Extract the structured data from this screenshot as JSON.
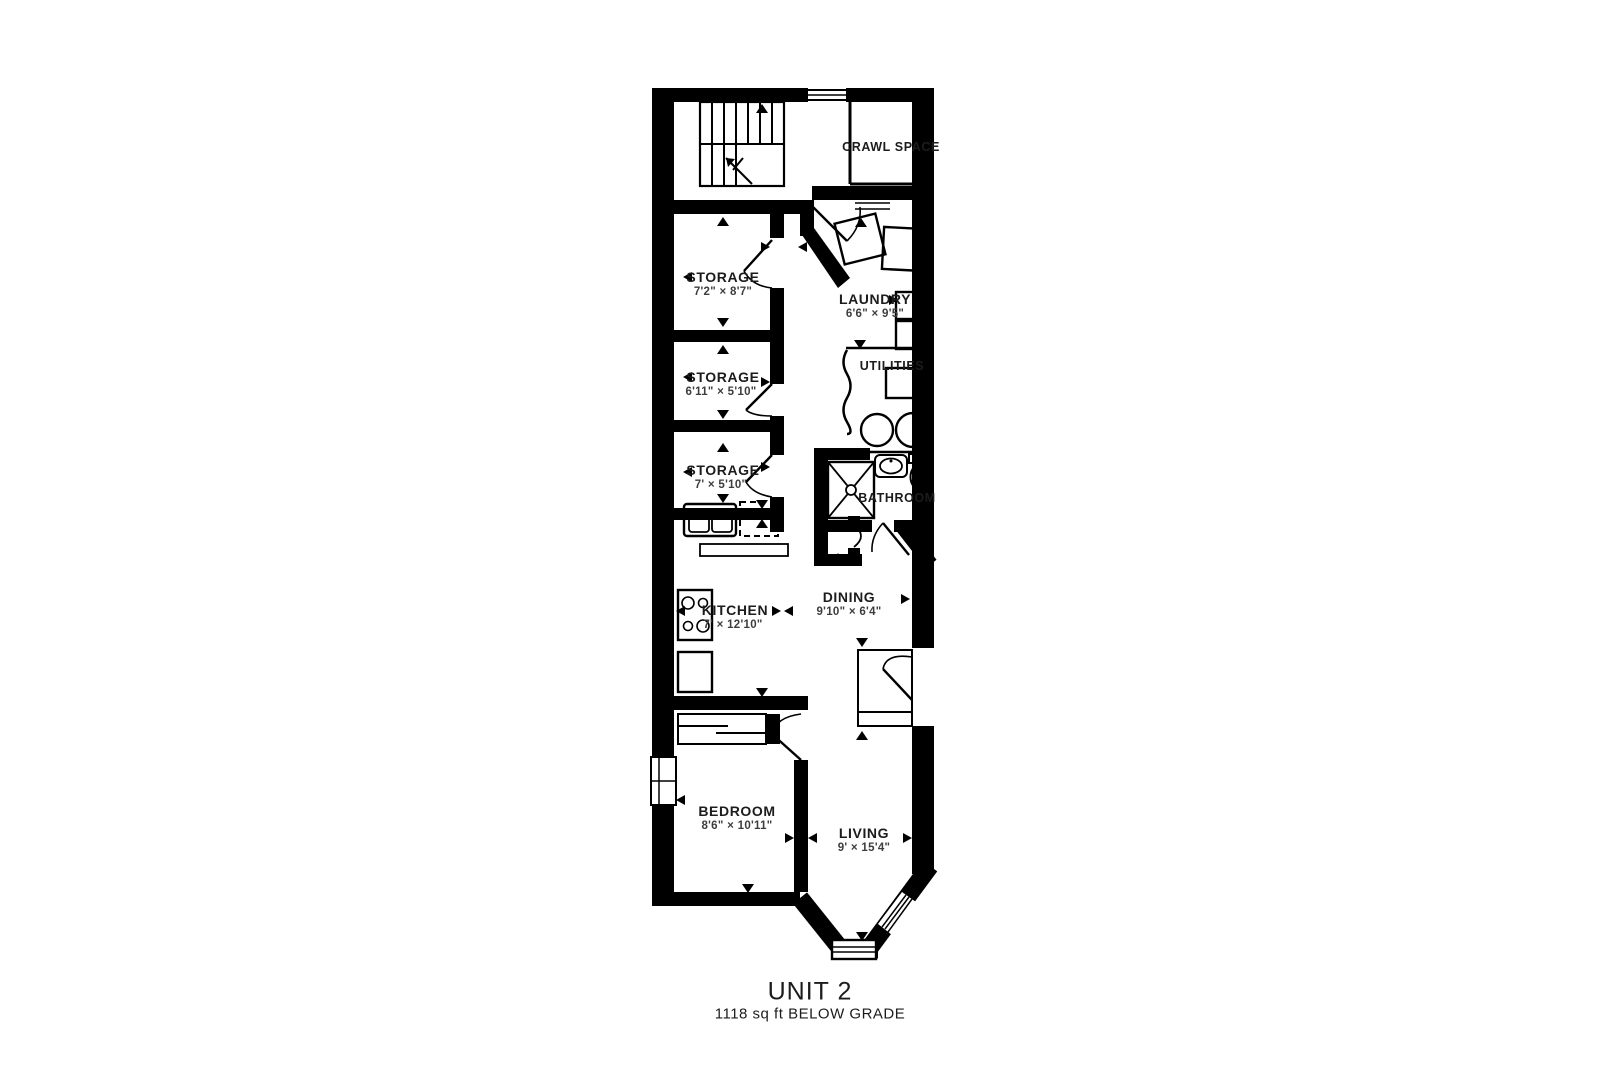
{
  "title": {
    "unit": "UNIT 2",
    "area": "1118 sq ft BELOW GRADE"
  },
  "rooms": {
    "crawl_space": {
      "name": "CRAWL SPACE"
    },
    "storage_1": {
      "name": "STORAGE",
      "dims": "7'2\" × 8'7\""
    },
    "laundry": {
      "name": "LAUNDRY",
      "dims": "6'6\" × 9'5\""
    },
    "storage_2": {
      "name": "STORAGE",
      "dims": "6'11\" × 5'10\""
    },
    "utilities": {
      "name": "UTILITIES"
    },
    "storage_3": {
      "name": "STORAGE",
      "dims": "7' × 5'10\""
    },
    "bathroom": {
      "name": "BATHROOM"
    },
    "kitchen": {
      "name": "KITCHEN",
      "dims": "7' × 12'10\""
    },
    "dining": {
      "name": "DINING",
      "dims": "9'10\" × 6'4\""
    },
    "bedroom": {
      "name": "BEDROOM",
      "dims": "8'6\" × 10'11\""
    },
    "living": {
      "name": "LIVING",
      "dims": "9' × 15'4\""
    }
  },
  "colors": {
    "wall": "#000000",
    "background": "#ffffff",
    "text": "#1c1c1c"
  }
}
